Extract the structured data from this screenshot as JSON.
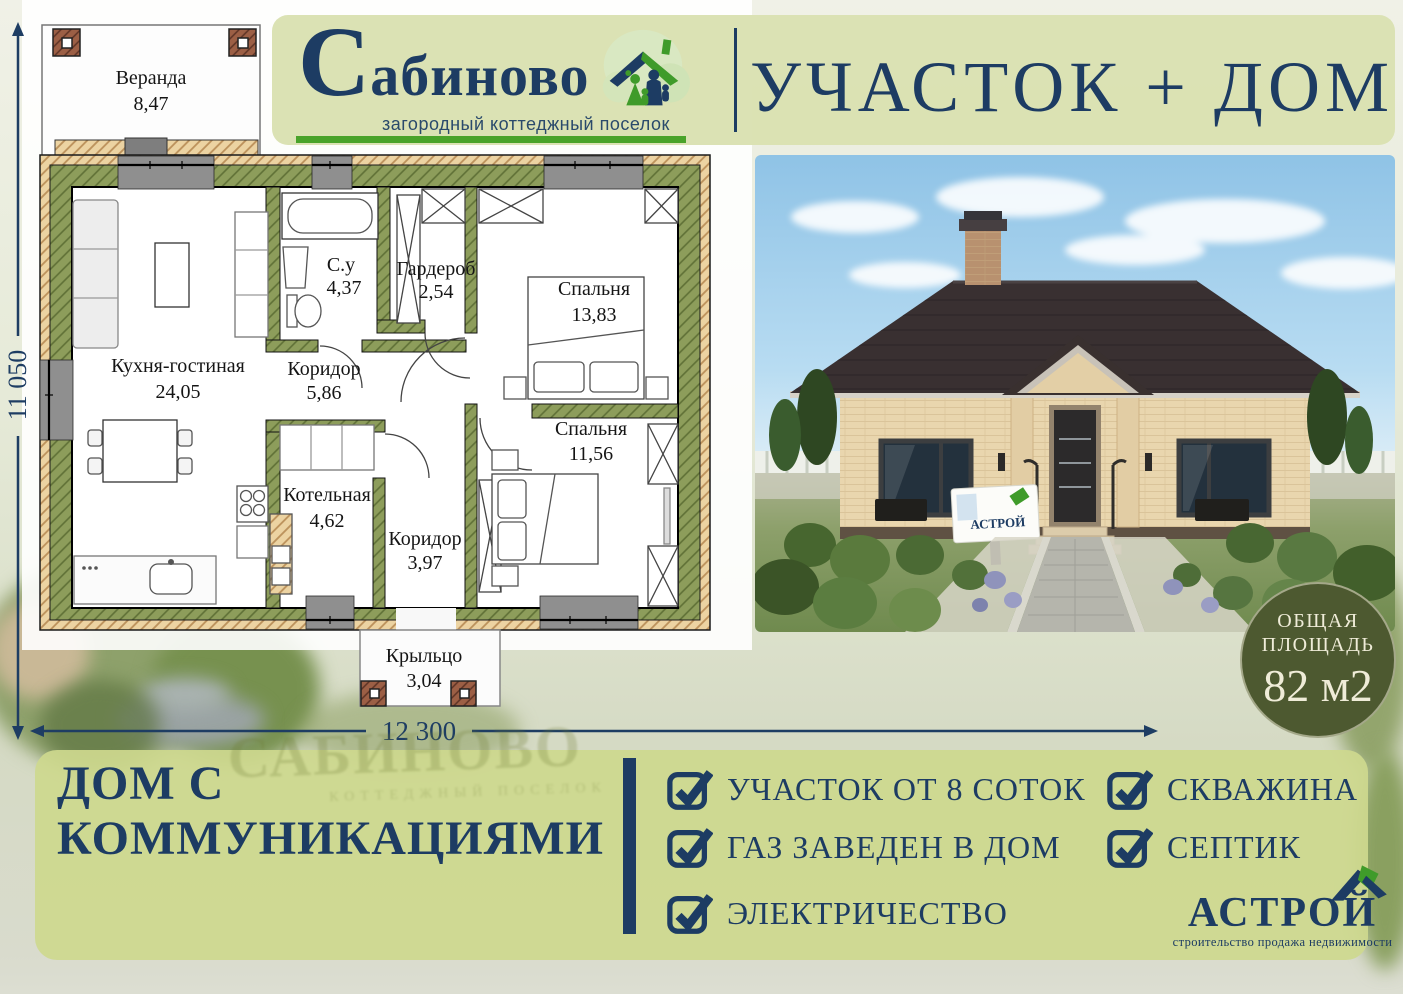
{
  "header": {
    "brand_initial": "С",
    "brand_rest": "абиново",
    "brand_subtitle": "загородный коттеджный поселок",
    "offer_title": "УЧАСТОК + ДОМ"
  },
  "floorplan": {
    "dim_height_mm": "11 050",
    "dim_width_mm": "12 300",
    "rooms": [
      {
        "name": "Веранда",
        "area": "8,47"
      },
      {
        "name": "Кухня-гостиная",
        "area": "24,05"
      },
      {
        "name": "С.у",
        "area": "4,37"
      },
      {
        "name": "Гардероб",
        "area": "2,54"
      },
      {
        "name": "Спальня",
        "area": "13,83"
      },
      {
        "name": "Коридор",
        "area": "5,86"
      },
      {
        "name": "Котельная",
        "area": "4,62"
      },
      {
        "name": "Коридор",
        "area": "3,97"
      },
      {
        "name": "Спальня",
        "area": "11,56"
      },
      {
        "name": "Крыльцо",
        "area": "3,04"
      }
    ]
  },
  "photo": {
    "sign_text": "АСТРОЙ"
  },
  "area_badge": {
    "line1": "ОБЩАЯ",
    "line2": "ПЛОЩАДЬ",
    "value": "82 м2"
  },
  "offer_details": {
    "headline_line1": "ДОМ С",
    "headline_line2": "КОММУНИКАЦИЯМИ",
    "features_col1": [
      "УЧАСТОК ОТ 8 СОТОК",
      "ГАЗ ЗАВЕДЕН В ДОМ",
      "ЭЛЕКТРИЧЕСТВО"
    ],
    "features_col2": [
      "СКВАЖИНА",
      "СЕПТИК"
    ]
  },
  "developer": {
    "name": "АСТРОЙ",
    "tagline": "строительство продажа недвижимости"
  },
  "background": {
    "watermark_title": "САБИНОВО",
    "watermark_subtitle": "КОТТЕДЖНЫЙ ПОСЕЛОК"
  },
  "colors": {
    "navy": "#1d3c63",
    "green": "#49a32a",
    "panel_green": "#dae1b2",
    "bottom_panel_green": "#ccd78e",
    "badge_olive": "#4d5930"
  }
}
